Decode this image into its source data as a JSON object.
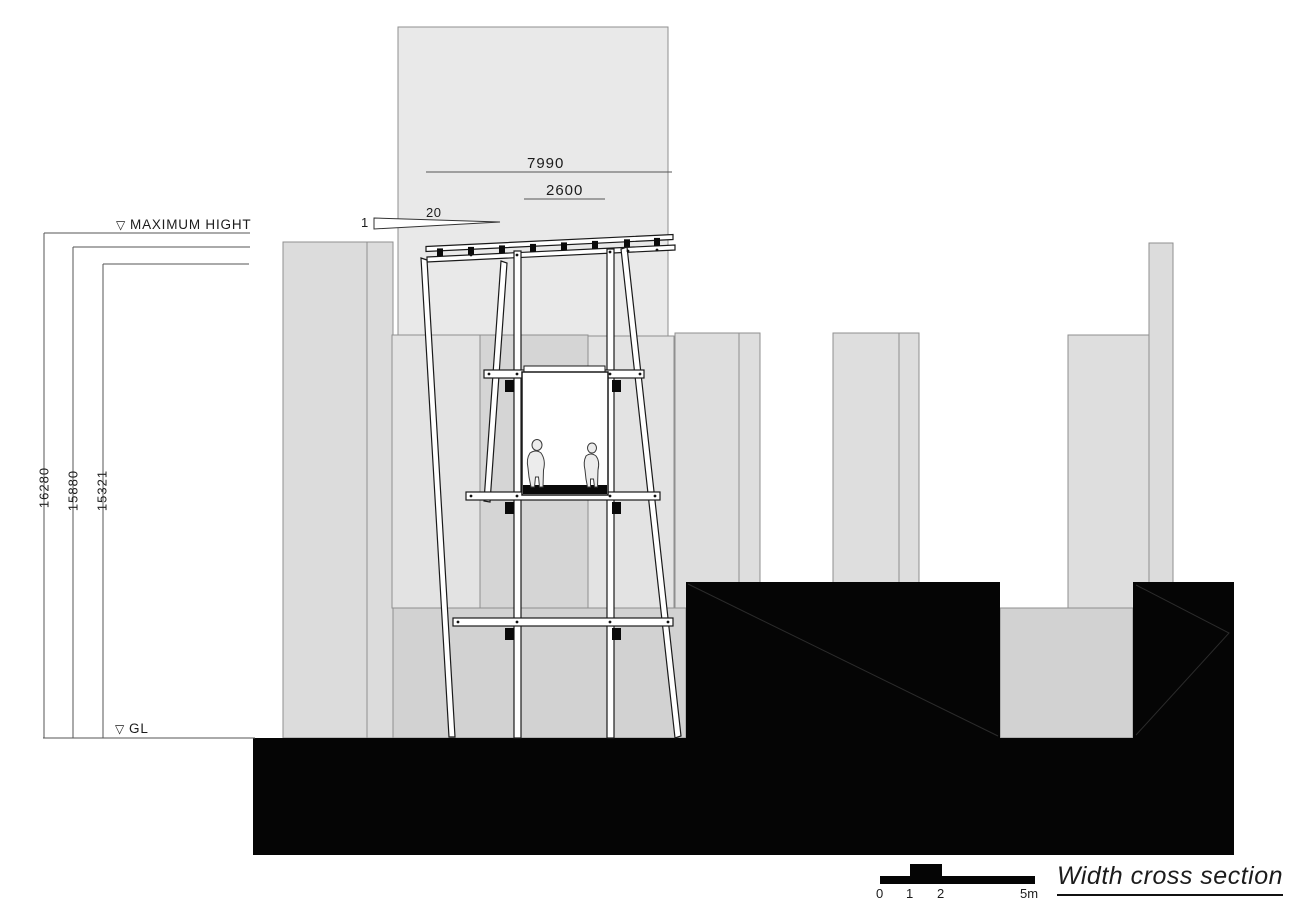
{
  "drawing": {
    "title": "Width cross section",
    "dims": {
      "overall_width": "7990",
      "opening_width": "2600",
      "slope_run": "20",
      "slope_rise": "1",
      "max_height": "16280",
      "mid_height": "15880",
      "inner_height": "15321"
    },
    "levels": {
      "marker": "▽",
      "max_label": "MAXIMUM HIGHT",
      "ground_label": "GL"
    },
    "scale_bar": {
      "tick0": "0",
      "tick1": "1",
      "tick2": "2",
      "tick5": "5m"
    },
    "colors": {
      "line": "#333333",
      "solid_fill": "#050505",
      "wall_light": "#e9e9e9",
      "wall_mid": "#d5d5d5",
      "ground_grey": "#d2d2d2"
    }
  }
}
